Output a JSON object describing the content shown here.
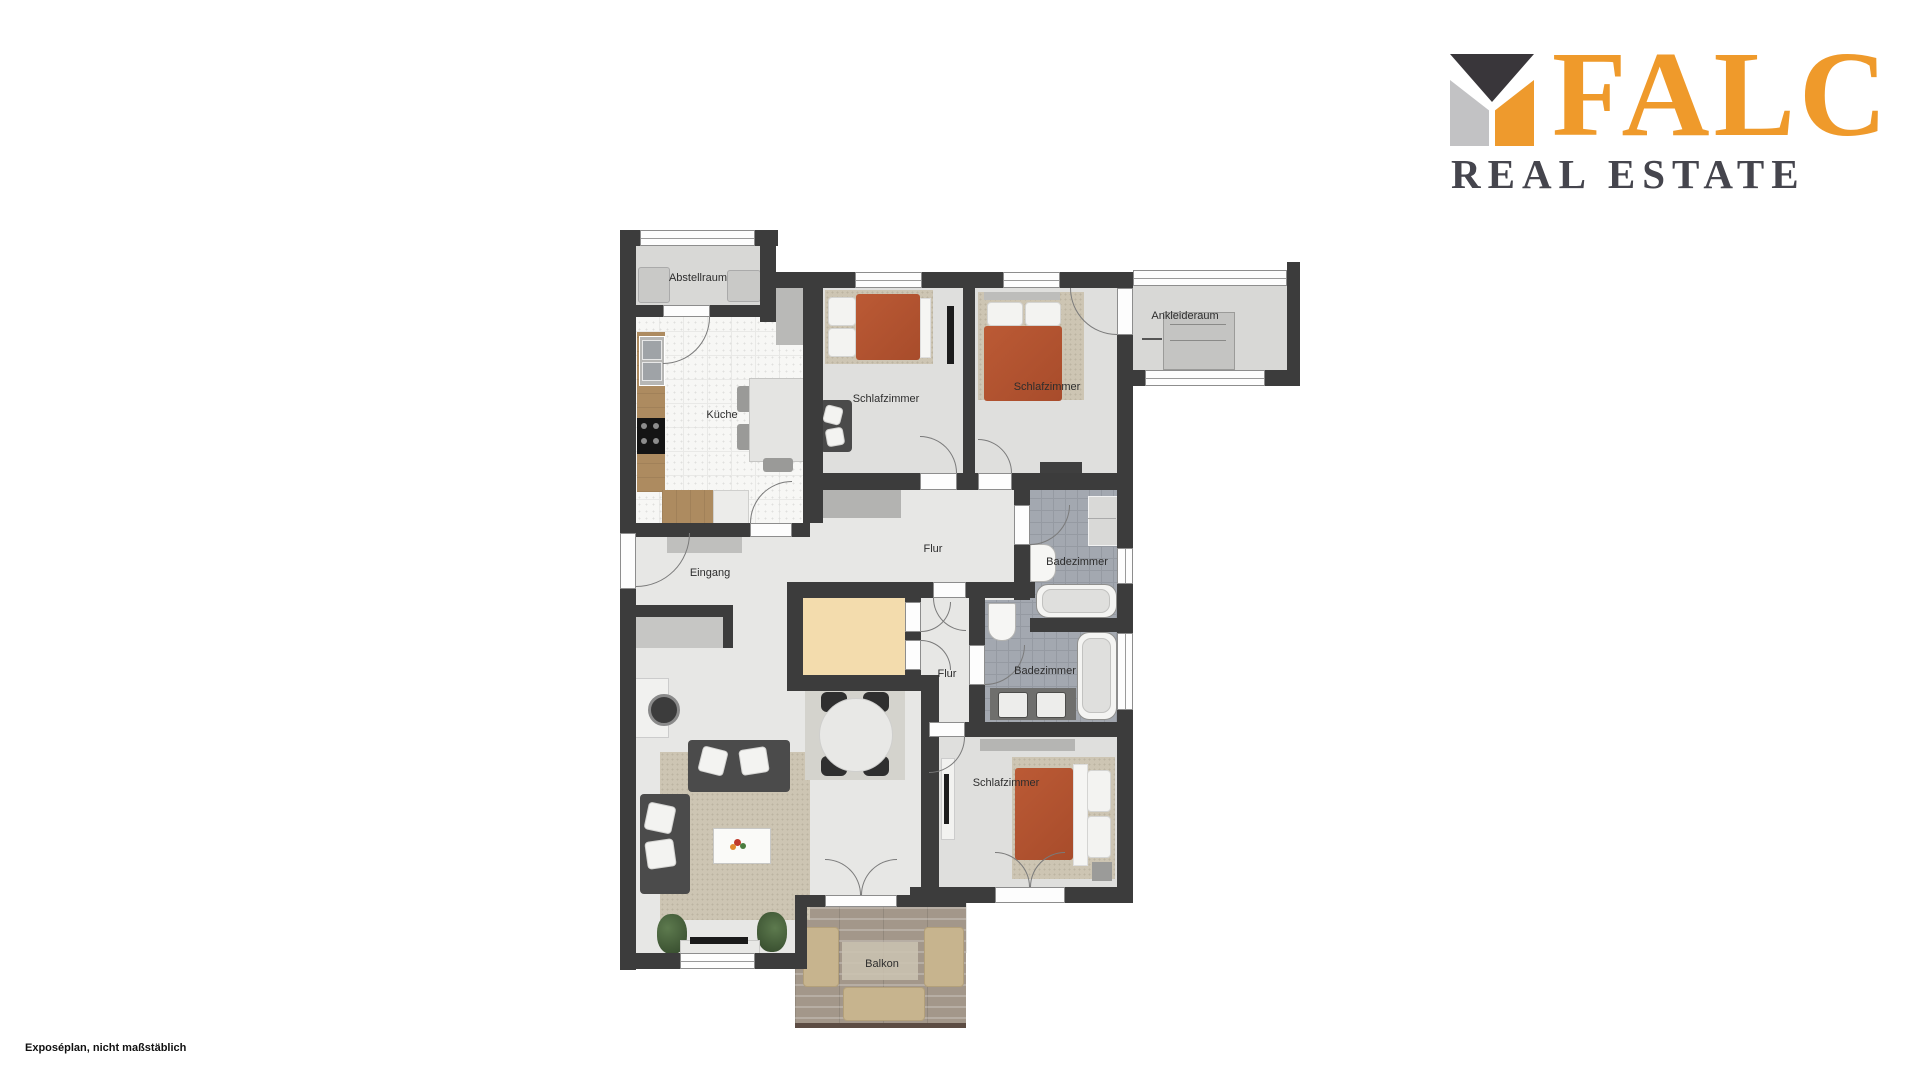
{
  "logo": {
    "brand": "FALC",
    "tagline": "REAL ESTATE",
    "colors": {
      "orange": "#EF9A2B",
      "dark_gray": "#39363A",
      "light_gray": "#C2C2C4",
      "text_gray": "#45454D"
    }
  },
  "footer": {
    "note": "Exposéplan, nicht maßstäblich"
  },
  "floorplan": {
    "wall_color": "#3C3C3C",
    "bed_color": "#B45330",
    "rooms": {
      "abstellraum": "Abstellraum",
      "kueche": "Küche",
      "schlafzimmer1": "Schlafzimmer",
      "schlafzimmer2": "Schlafzimmer",
      "ankleideraum": "Ankleideraum",
      "flur1": "Flur",
      "eingang": "Eingang",
      "badezimmer1": "Badezimmer",
      "flur2": "Flur",
      "badezimmer2": "Badezimmer",
      "schlafzimmer3": "Schlafzimmer",
      "balkon": "Balkon"
    }
  }
}
